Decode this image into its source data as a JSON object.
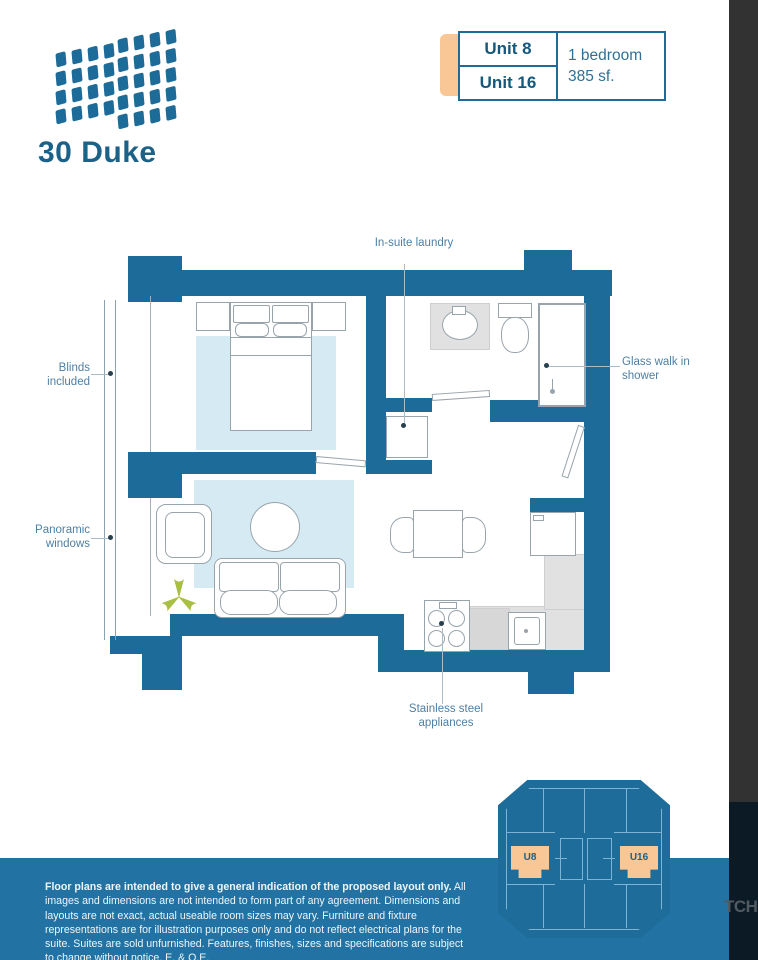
{
  "logo": {
    "name": "30 Duke"
  },
  "unit_card": {
    "unit_top": "Unit 8",
    "unit_bottom": "Unit 16",
    "bed_type": "1 bedroom",
    "area": "385 sf."
  },
  "plan_labels": {
    "laundry": "In-suite laundry",
    "blinds": "Blinds included",
    "windows": "Panoramic windows",
    "shower": "Glass walk in shower",
    "appliances": "Stainless steel appliances"
  },
  "keyplan": {
    "left_unit": "U8",
    "right_unit": "U16"
  },
  "footer": {
    "bold": "Floor plans are intended to give a general indication of the proposed layout only.",
    "rest": " All images and dimensions are not intended to form part of any agreement. Dimensions and layouts are not exact, actual useable room sizes may vary. Furniture and fixture representations are for illustration purposes only and do not reflect electrical plans for the suite. Suites are sold unfurnished. Features, finishes, sizes and specifications are subject to change without notice. E. & O.E."
  },
  "watermark": "TCH",
  "colors": {
    "wall_blue": "#1d6b98",
    "accent_orange": "#f8c795",
    "footer_blue": "#2273a3",
    "rug_blue": "#d6eaf3",
    "plant_green": "#a9bf44"
  }
}
